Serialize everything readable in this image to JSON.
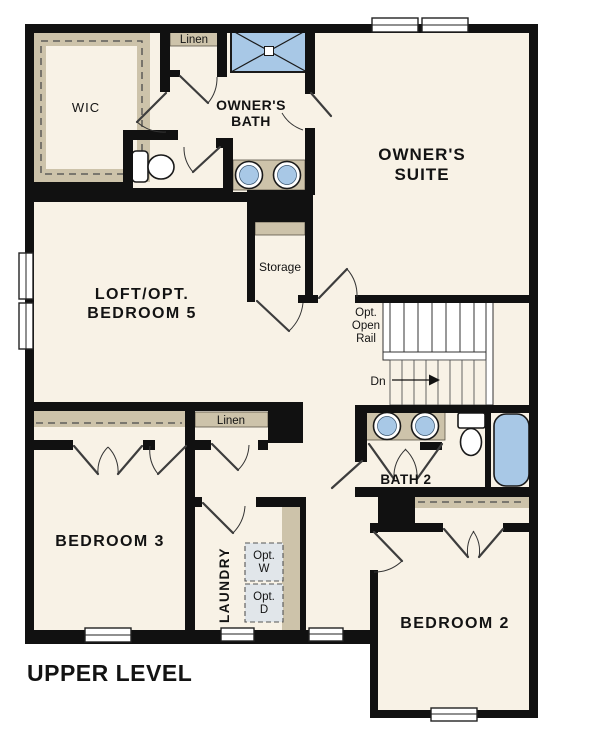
{
  "colors": {
    "background": "#ffffff",
    "wall": "#111111",
    "floor": "#f8f2e6",
    "casework": "#cdc3aa",
    "fixture_blue": "#a8c8e6",
    "appliance_gray": "#e1e6ea",
    "text": "#131313"
  },
  "rooms": {
    "wic": {
      "label": "WIC"
    },
    "linen_top": {
      "label": "Linen"
    },
    "owners_bath": {
      "line1": "OWNER'S",
      "line2": "BATH"
    },
    "owners_suite": {
      "line1": "OWNER'S",
      "line2": "SUITE"
    },
    "loft": {
      "line1": "LOFT/OPT.",
      "line2": "BEDROOM 5"
    },
    "storage": {
      "label": "Storage"
    },
    "bath2": {
      "label": "BATH 2"
    },
    "linen_hall": {
      "label": "Linen"
    },
    "bedroom3": {
      "label": "BEDROOM 3"
    },
    "laundry": {
      "label": "LAUNDRY",
      "washer": {
        "line1": "Opt.",
        "line2": "W"
      },
      "dryer": {
        "line1": "Opt.",
        "line2": "D"
      }
    },
    "bedroom2": {
      "label": "BEDROOM 2"
    }
  },
  "stairs": {
    "rail_note": {
      "line1": "Opt.",
      "line2": "Open",
      "line3": "Rail"
    },
    "direction_label": "Dn"
  },
  "footer": {
    "title": "UPPER LEVEL"
  }
}
